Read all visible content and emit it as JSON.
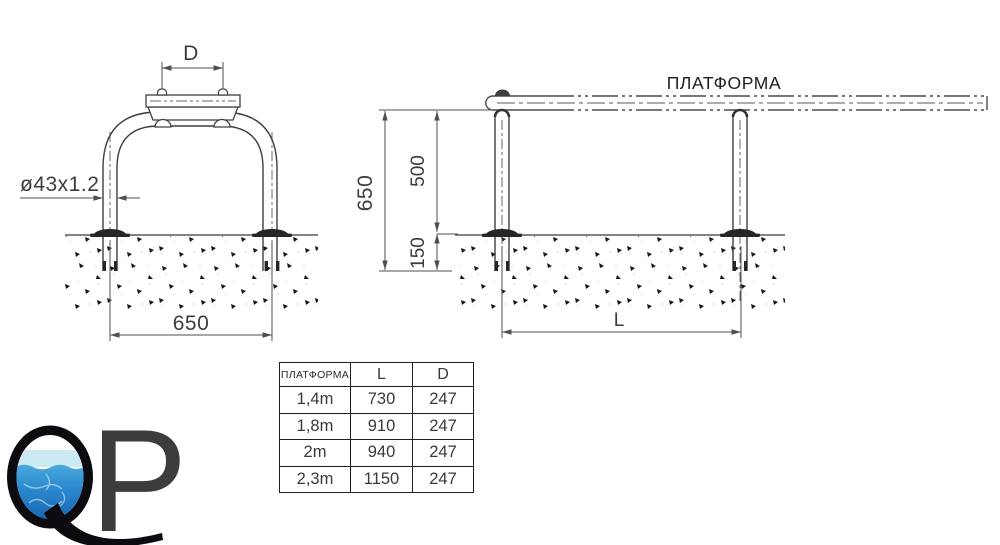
{
  "front_view": {
    "top_width_label": "D",
    "pipe_spec_label": "ø43x1.2",
    "base_width_label": "650"
  },
  "side_view": {
    "platform_label": "ПЛАТФОРМА",
    "overall_height_label": "650",
    "height_above_ground_label": "500",
    "embed_depth_label": "150",
    "post_spacing_label": "L"
  },
  "spec_table": {
    "headers": [
      "ПЛАТФОРМА",
      "L",
      "D"
    ],
    "rows": [
      [
        "1,4m",
        "730",
        "247"
      ],
      [
        "1,8m",
        "910",
        "247"
      ],
      [
        "2m",
        "940",
        "247"
      ],
      [
        "2,3m",
        "1150",
        "247"
      ]
    ]
  },
  "logo": {
    "letter_q": "Q",
    "letter_p": "P",
    "water_top_color": "#4aa9de",
    "water_bottom_color": "#1565b2"
  },
  "colors": {
    "line": "#434343",
    "dim_line": "#4f4f4f",
    "text": "#3c3c3c",
    "background": "#ffffff"
  }
}
